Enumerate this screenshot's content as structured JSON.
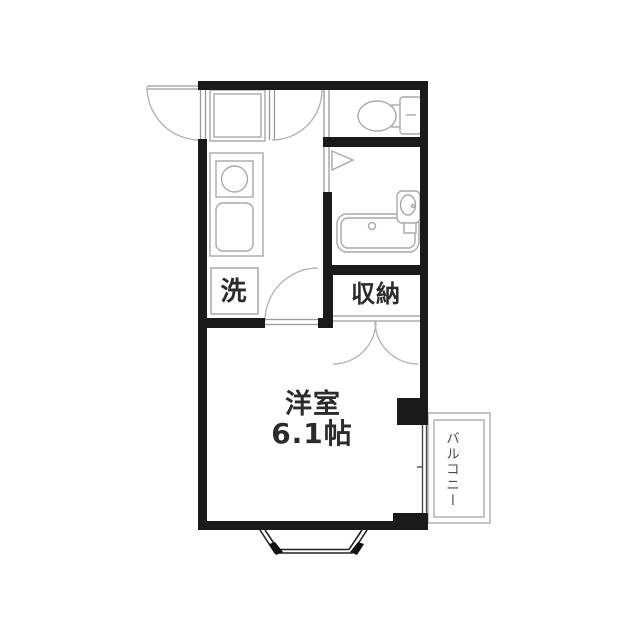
{
  "plan": {
    "type": "apartment-floor-plan",
    "rooms": {
      "western_room": {
        "name": "洋室",
        "size": "6.1帖"
      },
      "closet": {
        "label": "収納"
      },
      "washer_space": {
        "label": "洗"
      },
      "balcony": {
        "label": "バルコニー"
      }
    },
    "fixtures": [
      "entrance-door",
      "shoe-counter",
      "stove-burner",
      "kitchen-sink",
      "washing-machine-space",
      "hall-door",
      "toilet",
      "toilet-tank",
      "bathroom-folding-door",
      "bathtub",
      "wash-basin",
      "closet-double-doors",
      "room-door",
      "balcony-sliding-window",
      "bay-window",
      "wall-pillar"
    ],
    "colors": {
      "wall": "#1a1a1a",
      "fixture_line": "#a8a8a8",
      "door_arc": "#b5b5b5",
      "window_line": "#4a4a4a",
      "text": "#2b2b2b",
      "background": "#ffffff"
    }
  }
}
